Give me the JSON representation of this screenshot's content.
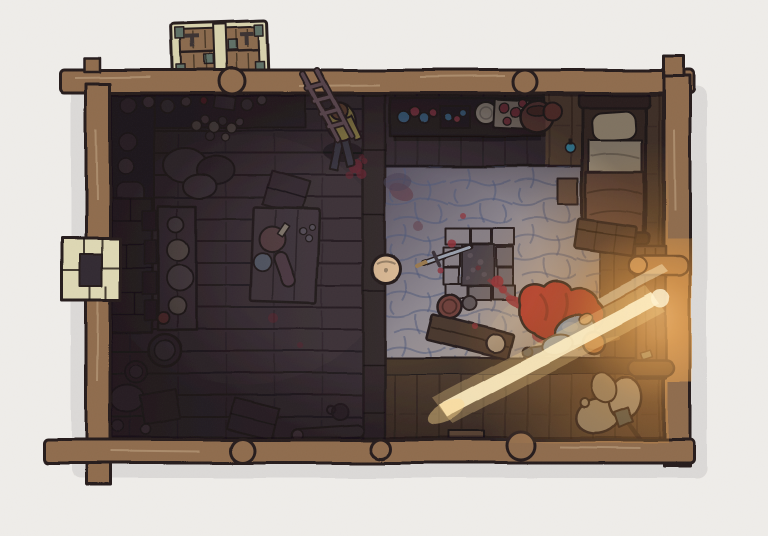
{
  "scene": {
    "type": "tabletop battle map",
    "view": "top-down",
    "setting": "log cabin / roadside inn interior",
    "style": "hand-drawn illustration on off-white parchment background",
    "rooms": [
      {
        "name": "common room",
        "floor": "dark wood planks",
        "position": "left half"
      },
      {
        "name": "hearth room",
        "floor": "gray flagstone",
        "position": "center-right"
      },
      {
        "name": "bedroom nook",
        "floor": "warm wood planks",
        "position": "top-right"
      },
      {
        "name": "entry corridor",
        "floor": "warm wood planks",
        "position": "bottom-right"
      }
    ],
    "tokens": [
      {
        "name": "villager",
        "appearance": "standing figure, olive shirt, dark trousers, brown hair",
        "position": "north side of common room"
      },
      {
        "name": "fallen adventurer",
        "appearance": "figure lying face down, red cloak, blue tunic, orange hair, blood pool",
        "position": "hearth room near east door"
      }
    ],
    "features": [
      "light rays shining through east door",
      "blood trail from stone fire pit to fallen body",
      "stacked crate pallet outside north wall",
      "stone chimney protruding from west wall",
      "round log joints at wall intersections"
    ],
    "objects": [
      "crate stack",
      "stone chimney",
      "interior hearth",
      "long table with plates",
      "dining table with ham, bread and plate",
      "wall shelves with pots and jars",
      "leaning ladder",
      "goods pile",
      "storage sacks",
      "barrels",
      "crates",
      "fallen mug",
      "firewood log",
      "potion counter",
      "potion bottles",
      "plate stack",
      "serving tray with red cups",
      "cauldron",
      "bed with pillow, sheet and blanket",
      "bedside shelf",
      "blue potion on floor",
      "wooden chest",
      "stone fire pit with ash",
      "dropped sword",
      "cooking pot",
      "small pot",
      "toppled bench with plate",
      "barrel lid",
      "east door",
      "grain sacks",
      "shovel",
      "blood splatters"
    ]
  },
  "palette": {
    "paper": "#efedea",
    "ink": "#251d1f",
    "wall_wood": "#8f6c4e",
    "wall_wood_light": "#a9855f",
    "floor_dark": "#3b3137",
    "floor_mid": "#4a3e44",
    "divider_wood": "#342a2d",
    "counter_floor": "#42383e",
    "stone_dark": "#575160",
    "stone_mid": "#8e8890",
    "stone_lit": "#baab99",
    "stone_joint": "#4e5878",
    "pit_stone": "#867e84",
    "pit_stone_dark": "#6c6469",
    "pit_inner": "#4a4147",
    "ash": "#5a4f55",
    "warm_floor": "#5e4938",
    "warm_floor_dark": "#4a392d",
    "warm_floor_lit": "#7a5a3c",
    "beam_dark": "#46372c",
    "door_wood": "#4e3b31",
    "blood": "#8e3039",
    "blood_dark": "#6e2833",
    "cape_red": "#a8342c",
    "cape_shadow": "#872a24",
    "tunic_blue": "#7fa3cc",
    "tunic_light": "#9db9d9",
    "hair_orange": "#d08448",
    "boots_blue": "#3f465f",
    "staff_wood": "#9a7a50",
    "skin": "#caa27a",
    "villager_shirt": "#97894c",
    "villager_hair": "#6b4a38",
    "villager_pants": "#3d3a46",
    "bed_frame": "#43332c",
    "bed_rail": "#392a25",
    "pillow": "#d6c6a4",
    "sheet": "#c8bb9f",
    "blanket": "#6e4f41",
    "sack_light": "#e5dabc",
    "sack_mid": "#d3c5a4",
    "chimney_stone": "#ded8b4",
    "chimney_hole": "#332c30",
    "hearth_stone": "#372f33",
    "hearth_stone2": "#2f282c",
    "crate_wood": "#8a6b4e",
    "crate_frame": "#d8d2ad",
    "crate_bracket": "#5f7066",
    "dark_crate": "#3b3036",
    "table_wood": "#453a41",
    "stool_gray": "#5a4e53",
    "clutter": "#4a4046",
    "clutter_light": "#6e635c",
    "mug_red": "#6e3a3a",
    "pot_brown": "#7a4f44",
    "pot_red": "#6e3a35",
    "potion_blue": "#4a7fa8",
    "potion_red": "#a04550",
    "potion_teal": "#3fa8c9",
    "plate_light": "#c9bfae",
    "plate_pale": "#a5927c",
    "tray": "#b3a797",
    "barrel_top": "#d9b894",
    "bench_wood": "#4a382e",
    "metal": "#9aa0ad",
    "tool_teal": "#6a7a6e",
    "ray": "#ffeec2",
    "ray_soft": "#ffd98f",
    "log_dark": "#3c3136",
    "shelf_dark": "#30282c"
  }
}
